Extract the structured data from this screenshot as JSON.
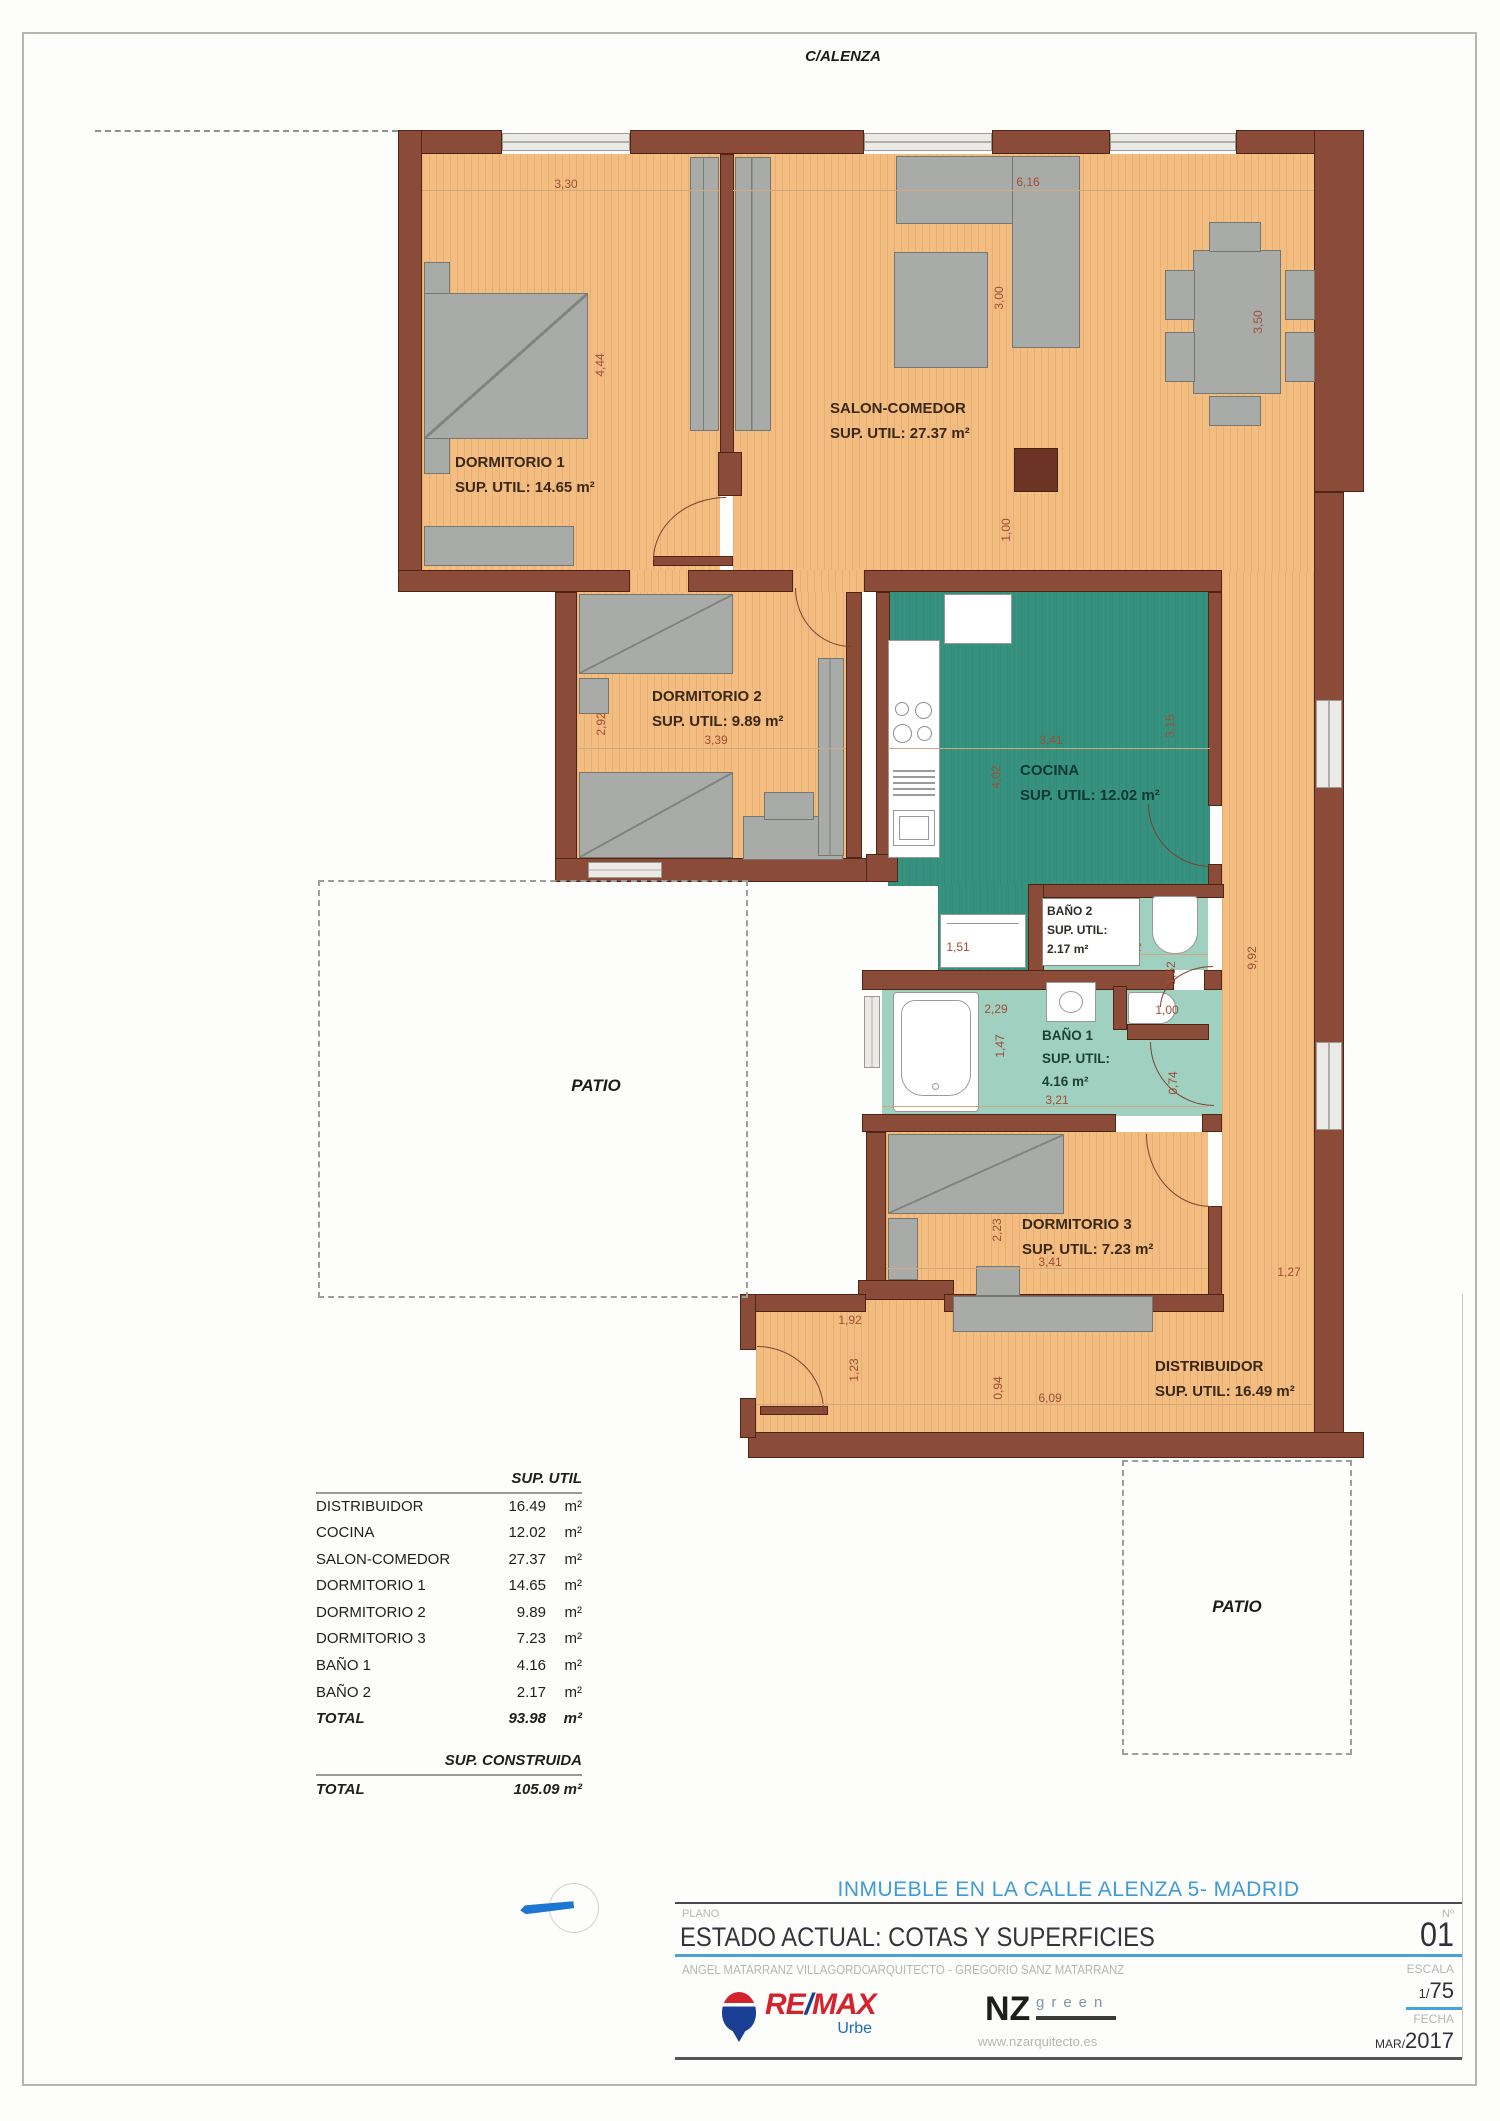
{
  "street_label": "C/ALENZA",
  "plan": {
    "patio": "PATIO",
    "rooms": {
      "dorm1": {
        "name": "DORMITORIO 1",
        "area": "SUP. UTIL: 14.65 m²"
      },
      "salon": {
        "name": "SALON-COMEDOR",
        "area": "SUP. UTIL: 27.37 m²"
      },
      "dorm2": {
        "name": "DORMITORIO 2",
        "area": "SUP. UTIL: 9.89 m²"
      },
      "cocina": {
        "name": "COCINA",
        "area": "SUP. UTIL: 12.02 m²"
      },
      "bano2": {
        "name": "BAÑO 2",
        "l2": "SUP. UTIL:",
        "l3": "2.17 m²"
      },
      "bano1": {
        "name": "BAÑO 1",
        "l2": "SUP. UTIL:",
        "l3": "4.16 m²"
      },
      "dorm3": {
        "name": "DORMITORIO 3",
        "area": "SUP. UTIL: 7.23 m²"
      },
      "distribuidor": {
        "name": "DISTRIBUIDOR",
        "area": "SUP. UTIL: 16.49 m²"
      }
    }
  },
  "dims": [
    {
      "v": "3,30"
    },
    {
      "v": "6,16"
    },
    {
      "v": "4,44"
    },
    {
      "v": "3,00"
    },
    {
      "v": "3,50"
    },
    {
      "v": "1,00"
    },
    {
      "v": "2,92"
    },
    {
      "v": "3,39"
    },
    {
      "v": "3,41"
    },
    {
      "v": "3,15"
    },
    {
      "v": "4,02"
    },
    {
      "v": "9,92"
    },
    {
      "v": "1,51"
    },
    {
      "v": "1,82"
    },
    {
      "v": "1,52"
    },
    {
      "v": "2,29"
    },
    {
      "v": "1,00"
    },
    {
      "v": "1,47"
    },
    {
      "v": "0,74"
    },
    {
      "v": "3,21"
    },
    {
      "v": "2,23"
    },
    {
      "v": "3,41"
    },
    {
      "v": "1,27"
    },
    {
      "v": "1,92"
    },
    {
      "v": "1,23"
    },
    {
      "v": "0,94"
    },
    {
      "v": "6,09"
    }
  ],
  "surface_table": {
    "header": "SUP. UTIL",
    "rows": [
      {
        "label": "DISTRIBUIDOR",
        "value": "16.49",
        "unit": "m²"
      },
      {
        "label": "COCINA",
        "value": "12.02",
        "unit": "m²"
      },
      {
        "label": "SALON-COMEDOR",
        "value": "27.37",
        "unit": "m²"
      },
      {
        "label": "DORMITORIO 1",
        "value": "14.65",
        "unit": "m²"
      },
      {
        "label": "DORMITORIO 2",
        "value": "9.89",
        "unit": "m²"
      },
      {
        "label": "DORMITORIO 3",
        "value": "7.23",
        "unit": "m²"
      },
      {
        "label": "BAÑO 1",
        "value": "4.16",
        "unit": "m²"
      },
      {
        "label": "BAÑO 2",
        "value": "2.17",
        "unit": "m²"
      },
      {
        "label": "TOTAL",
        "value": "93.98",
        "unit": "m²"
      }
    ],
    "built_header": "SUP. CONSTRUIDA",
    "built_row": {
      "label": "TOTAL",
      "value": "105.09 m²"
    }
  },
  "title_block": {
    "project": "INMUEBLE EN LA CALLE ALENZA 5- MADRID",
    "plano_label": "PLANO",
    "plano_value": "ESTADO ACTUAL: COTAS Y SUPERFICIES",
    "num_label": "Nº",
    "num_value": "01",
    "author": "ANGEL MATARRANZ VILLAGORDO",
    "architect": "ARQUITECTO - GREGORIO SANZ MATARRANZ",
    "escala_label": "ESCALA",
    "escala_small": "1/",
    "escala_big": "75",
    "fecha_label": "FECHA",
    "fecha_small": "MAR/",
    "fecha_big": "2017"
  },
  "logos": {
    "remax_re": "RE",
    "remax_slash": "/",
    "remax_max": "MAX",
    "remax_sub": "Urbe",
    "nz": "NZ",
    "nz_green": "green",
    "nz_web": "www.nzarquitecto.es"
  },
  "colors": {
    "wall": "#8a4b39",
    "wood_floor": "#f3bd82",
    "kitchen_floor": "#37917f",
    "bath_floor": "#9fd0c0",
    "furniture": "#a9aba8",
    "dim_text": "#a04e36",
    "title_blue": "#4aa3d8",
    "remax_red": "#d5232e",
    "remax_blue": "#1b3f94"
  }
}
